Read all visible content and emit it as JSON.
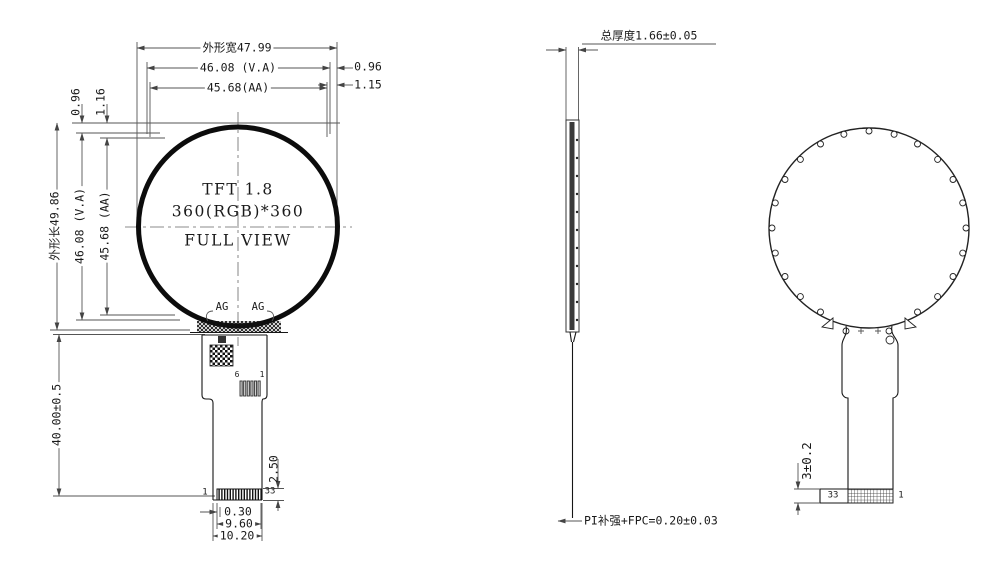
{
  "meta": {
    "drawing_type": "TFT display module dimensional drawing",
    "line_color": "#1a1a1a",
    "background": "#ffffff"
  },
  "front_view": {
    "width_dims": {
      "outer": "外形宽47.99",
      "va": "46.08 (V.A)",
      "aa": "45.68(AA)",
      "edge_to_va": "0.96",
      "edge_to_aa": "1.15"
    },
    "height_dims": {
      "outer": "外形长49.86",
      "va": "46.08 (V.A)",
      "aa": "45.68 (AA)",
      "edge_to_va": "0.96",
      "edge_to_aa": "1.16",
      "tail_length": "40.00±0.5"
    },
    "panel_label": {
      "line1": "TFT 1.8",
      "line2": "360(RGB)*360",
      "line3": "FULL VIEW"
    },
    "ag_left": "AG",
    "ag_right": "AG",
    "bond_pins": {
      "left": "6",
      "right": "1"
    },
    "connector": {
      "pin_left": "1",
      "pin_right": "33",
      "pitch": "0.30",
      "contacts_width": "9.60",
      "tail_width": "10.20",
      "contact_height": "2.50"
    }
  },
  "side_view": {
    "thickness": "总厚度1.66±0.05",
    "fpc_note": "PI补强+FPC=0.20±0.03"
  },
  "back_view": {
    "stiffener": "3±0.2",
    "pin_left": "33",
    "pin_right": "1"
  }
}
